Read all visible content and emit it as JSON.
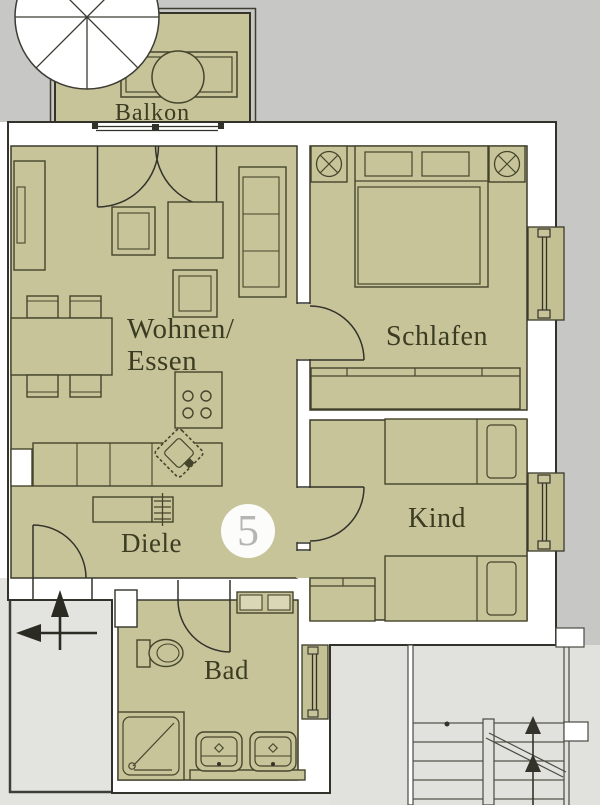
{
  "plan": {
    "unit_number": "5",
    "labels": {
      "balkon": "Balkon",
      "wohnen_line1": "Wohnen/",
      "wohnen_line2": "Essen",
      "schlafen": "Schlafen",
      "kind": "Kind",
      "diele": "Diele",
      "bad": "Bad"
    },
    "colors": {
      "room_fill": "#c7c49a",
      "wall_fill": "#ffffff",
      "outline": "#33332a",
      "outside_upper": "#c7c7c5",
      "outside_lower": "#e3e3e0",
      "label_text": "#3c3c22",
      "unit_number_text": "#b5b5b2"
    }
  }
}
